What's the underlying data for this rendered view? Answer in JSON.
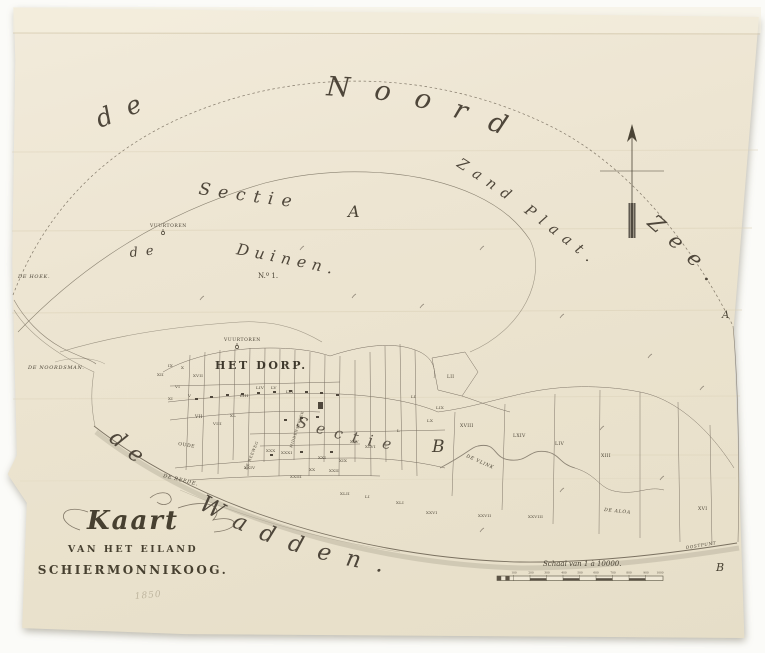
{
  "palette": {
    "paper": "#ece4d0",
    "ink": "#665d4e",
    "text": "#4a4335",
    "shore": "#b0a894"
  },
  "title": {
    "line1": "Kaart",
    "line2": "VAN HET EILAND",
    "line3": "SCHIERMONNIKOOG."
  },
  "sea": {
    "de_north": "de",
    "noord": "Noord",
    "zand_plaat": "Zand Plaat.",
    "zee": "Zee.",
    "de_south": "de",
    "wadden": "Wadden.",
    "duinen_de": "de",
    "duinen": "Duinen.",
    "sectie_a": "Sectie",
    "sectie_b": "Sectie"
  },
  "scale": {
    "caption": "Schaal van 1 à 10000."
  },
  "map": {
    "labels": [
      {
        "t": "VUURTOREN",
        "x": 150,
        "y": 227,
        "s": 4.5,
        "c": "caps",
        "n": "lighthouse-north-label"
      },
      {
        "t": "VUURTOREN",
        "x": 224,
        "y": 341,
        "s": 4.5,
        "c": "caps",
        "n": "lighthouse-south-label"
      },
      {
        "t": "N.º 1.",
        "x": 258,
        "y": 278,
        "s": 7,
        "c": "ser",
        "n": "section-number"
      },
      {
        "t": "HET DORP.",
        "x": 215,
        "y": 369,
        "s": 11,
        "c": "dorp",
        "n": "village-label"
      },
      {
        "t": "DE HOEK.",
        "x": 18,
        "y": 278,
        "s": 5,
        "c": "capsi",
        "n": "de-hoek-label"
      },
      {
        "t": "DE NOORDSMAN.",
        "x": 28,
        "y": 369,
        "s": 5,
        "c": "capsi",
        "n": "de-noordsman-label"
      },
      {
        "t": "DE REEDE.",
        "x": 163,
        "y": 477,
        "s": 5,
        "r": 14,
        "c": "capsi",
        "n": "de-reede-label"
      },
      {
        "t": "OUDE",
        "x": 178,
        "y": 445,
        "s": 4.6,
        "r": 10,
        "c": "caps"
      },
      {
        "t": "DE REEWEG",
        "x": 247,
        "y": 470,
        "s": 3.8,
        "r": -68,
        "c": "caps"
      },
      {
        "t": "MIDDENSTREEK",
        "x": 292,
        "y": 448,
        "s": 3.5,
        "r": -72,
        "c": "caps"
      },
      {
        "t": "DE VLINK",
        "x": 466,
        "y": 457,
        "s": 4.6,
        "r": 24,
        "c": "capsi",
        "n": "de-vlink-label"
      },
      {
        "t": "DE ALOA",
        "x": 604,
        "y": 511,
        "s": 4.6,
        "r": 6,
        "c": "capsi"
      },
      {
        "t": "OOSTPUNT",
        "x": 686,
        "y": 549,
        "s": 4.2,
        "r": -9,
        "c": "capsi"
      },
      {
        "t": "A",
        "x": 722,
        "y": 318,
        "s": 10,
        "c": "seri",
        "n": "edge-marker-a"
      },
      {
        "t": "B",
        "x": 716,
        "y": 571,
        "s": 11,
        "c": "seri",
        "n": "edge-marker-b"
      },
      {
        "t": "A",
        "x": 348,
        "y": 217,
        "s": 16,
        "c": "seri",
        "n": "sectie-a-letter"
      },
      {
        "t": "B",
        "x": 432,
        "y": 452,
        "s": 17,
        "c": "seri",
        "n": "sectie-b-letter"
      },
      {
        "t": "1850",
        "x": 135,
        "y": 599,
        "s": 9,
        "r": -5,
        "c": "pencil",
        "n": "pencil-year"
      },
      {
        "t": "IX",
        "x": 168,
        "y": 367,
        "s": 4,
        "c": "par"
      },
      {
        "t": "X",
        "x": 181,
        "y": 369,
        "s": 4,
        "c": "par"
      },
      {
        "t": "XVII",
        "x": 193,
        "y": 377,
        "s": 4,
        "c": "par"
      },
      {
        "t": "XII",
        "x": 157,
        "y": 376,
        "s": 4,
        "c": "par"
      },
      {
        "t": "VI",
        "x": 175,
        "y": 388,
        "s": 4,
        "c": "par"
      },
      {
        "t": "XI",
        "x": 168,
        "y": 400,
        "s": 4,
        "c": "par"
      },
      {
        "t": "V",
        "x": 188,
        "y": 397,
        "s": 4,
        "c": "par"
      },
      {
        "t": "LIII",
        "x": 240,
        "y": 397,
        "s": 4,
        "c": "par"
      },
      {
        "t": "LIV",
        "x": 256,
        "y": 389,
        "s": 4,
        "c": "par"
      },
      {
        "t": "LV",
        "x": 271,
        "y": 389,
        "s": 4,
        "c": "par"
      },
      {
        "t": "LVI",
        "x": 286,
        "y": 393,
        "s": 4,
        "c": "par"
      },
      {
        "t": "VII",
        "x": 195,
        "y": 418,
        "s": 4.4,
        "c": "par"
      },
      {
        "t": "VIII",
        "x": 213,
        "y": 425,
        "s": 4,
        "c": "par"
      },
      {
        "t": "XL",
        "x": 230,
        "y": 417,
        "s": 4,
        "c": "par"
      },
      {
        "t": "XXIV",
        "x": 244,
        "y": 469,
        "s": 4,
        "c": "par"
      },
      {
        "t": "XXX",
        "x": 266,
        "y": 452,
        "s": 4,
        "c": "par"
      },
      {
        "t": "XXXI",
        "x": 281,
        "y": 454,
        "s": 4,
        "c": "par"
      },
      {
        "t": "XXI",
        "x": 318,
        "y": 459,
        "s": 4,
        "c": "par"
      },
      {
        "t": "XX",
        "x": 309,
        "y": 471,
        "s": 4,
        "c": "par"
      },
      {
        "t": "XXII",
        "x": 329,
        "y": 472,
        "s": 4,
        "c": "par"
      },
      {
        "t": "XIX",
        "x": 339,
        "y": 462,
        "s": 4,
        "c": "par"
      },
      {
        "t": "XXIII",
        "x": 290,
        "y": 478,
        "s": 4,
        "c": "par"
      },
      {
        "t": "XLV",
        "x": 350,
        "y": 443,
        "s": 4,
        "c": "par"
      },
      {
        "t": "XLVI",
        "x": 365,
        "y": 448,
        "s": 4,
        "c": "par"
      },
      {
        "t": "L",
        "x": 397,
        "y": 432,
        "s": 4,
        "c": "par"
      },
      {
        "t": "LI",
        "x": 411,
        "y": 398,
        "s": 4,
        "c": "par"
      },
      {
        "t": "LIX",
        "x": 436,
        "y": 409,
        "s": 4,
        "c": "par"
      },
      {
        "t": "LX",
        "x": 427,
        "y": 422,
        "s": 4,
        "c": "par"
      },
      {
        "t": "LII",
        "x": 447,
        "y": 378,
        "s": 4.4,
        "c": "par"
      },
      {
        "t": "XVIII",
        "x": 460,
        "y": 427,
        "s": 4.6,
        "c": "par"
      },
      {
        "t": "LXIV",
        "x": 513,
        "y": 437,
        "s": 4.6,
        "c": "par"
      },
      {
        "t": "LIV",
        "x": 555,
        "y": 445,
        "s": 4.6,
        "c": "par"
      },
      {
        "t": "XIII",
        "x": 601,
        "y": 457,
        "s": 4.6,
        "c": "par"
      },
      {
        "t": "XVI",
        "x": 698,
        "y": 510,
        "s": 4.6,
        "c": "par"
      },
      {
        "t": "XLII",
        "x": 340,
        "y": 495,
        "s": 4,
        "c": "par"
      },
      {
        "t": "LI",
        "x": 365,
        "y": 498,
        "s": 4,
        "c": "par"
      },
      {
        "t": "XLI",
        "x": 396,
        "y": 504,
        "s": 4,
        "c": "par"
      },
      {
        "t": "XXVI",
        "x": 426,
        "y": 514,
        "s": 4,
        "c": "par"
      },
      {
        "t": "XXVII",
        "x": 478,
        "y": 517,
        "s": 4,
        "c": "par"
      },
      {
        "t": "XXVIII",
        "x": 528,
        "y": 518,
        "s": 4,
        "c": "par"
      },
      {
        "t": "100",
        "x": 514,
        "y": 573.5,
        "s": 2.8,
        "c": "num"
      },
      {
        "t": "200",
        "x": 531,
        "y": 573.5,
        "s": 2.8,
        "c": "num"
      },
      {
        "t": "300",
        "x": 547,
        "y": 573.5,
        "s": 2.8,
        "c": "num"
      },
      {
        "t": "400",
        "x": 564,
        "y": 573.5,
        "s": 2.8,
        "c": "num"
      },
      {
        "t": "500",
        "x": 580,
        "y": 573.5,
        "s": 2.8,
        "c": "num"
      },
      {
        "t": "600",
        "x": 596,
        "y": 573.5,
        "s": 2.8,
        "c": "num"
      },
      {
        "t": "700",
        "x": 613,
        "y": 573.5,
        "s": 2.8,
        "c": "num"
      },
      {
        "t": "800",
        "x": 629,
        "y": 573.5,
        "s": 2.8,
        "c": "num"
      },
      {
        "t": "900",
        "x": 646,
        "y": 573.5,
        "s": 2.8,
        "c": "num"
      },
      {
        "t": "1000",
        "x": 660,
        "y": 573.5,
        "s": 2.8,
        "c": "num"
      }
    ]
  }
}
